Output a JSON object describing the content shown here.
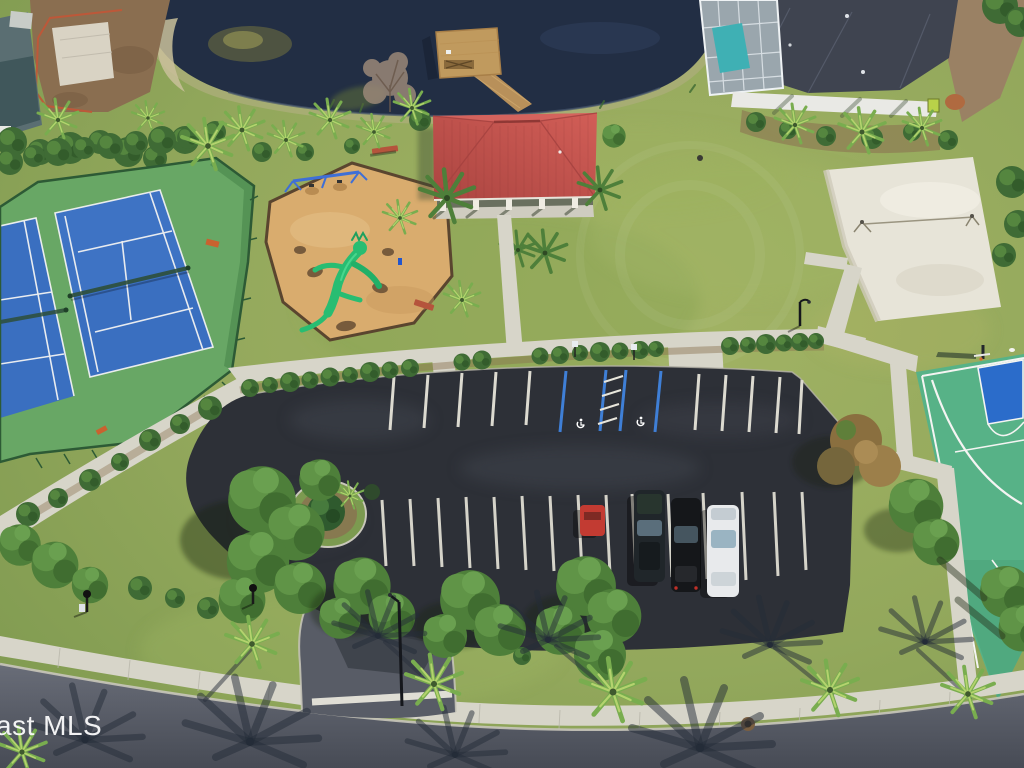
{
  "watermark": {
    "text": "ast MLS"
  },
  "scene": {
    "label": "Aerial view of community recreation area",
    "features": [
      "pond",
      "dock",
      "pavilion",
      "tennis courts",
      "playground",
      "sand volleyball court",
      "basketball court",
      "parking lot",
      "entrance drive",
      "street",
      "sidewalks",
      "palm trees",
      "house with pool enclosure"
    ],
    "palette": {
      "lawn": "#93a85c",
      "pond_water": "#222e44",
      "pavilion_roof": "#c4524e",
      "tennis_court_blue": "#3a6fc0",
      "tennis_apron_green": "#68a765",
      "basketball_green": "#57b287",
      "basketball_key_blue": "#2b6cca",
      "playground_sand": "#d9ac6e",
      "play_structure_green": "#28bd72",
      "volleyball_sand": "#e7e4d8",
      "parking_asphalt": "#2d3037",
      "street_asphalt": "#585c66",
      "sidewalk_concrete": "#d7d5c9",
      "dock_wood": "#c09a5e",
      "house_roof": "#3f4450",
      "pool_water": "#3fb0b4",
      "handicap_blue": "#3f7fd6"
    },
    "vehicles": [
      {
        "name": "red-car",
        "color": "#c23b32"
      },
      {
        "name": "dark-suv",
        "color": "#20262a"
      },
      {
        "name": "black-car",
        "color": "#15171a"
      },
      {
        "name": "white-car",
        "color": "#e8eaec"
      }
    ]
  }
}
